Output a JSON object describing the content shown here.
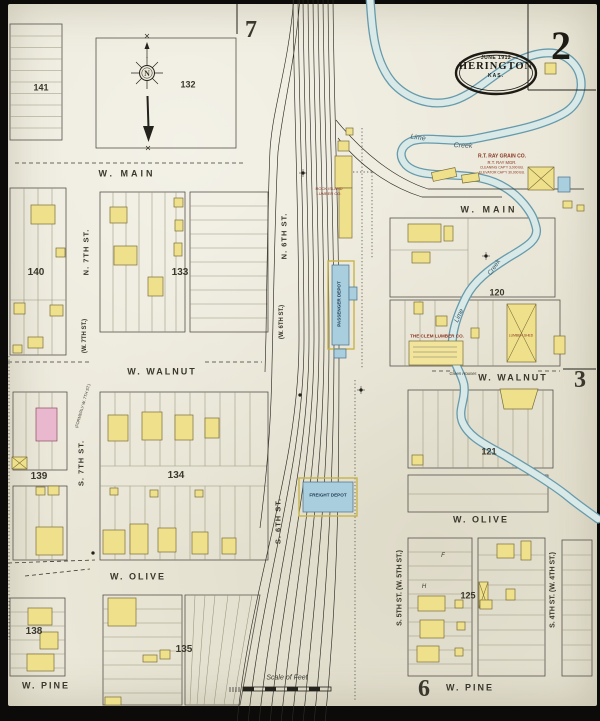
{
  "page": {
    "sheet_number": "2",
    "seal": {
      "date": "JUNE 1912",
      "city": "HERINGTON",
      "state": "KAS."
    },
    "adjacent_sheet_refs": {
      "top": "7",
      "right": "3",
      "bottom": "6"
    },
    "scale_label": "Scale of Feet",
    "compass_letter": "N"
  },
  "summary": {
    "streets_horizontal": [
      "W. MAIN",
      "W. WALNUT",
      "W. OLIVE",
      "W. PINE"
    ],
    "streets_vertical": [
      "N. 7TH ST.",
      "N. 6TH ST.",
      "S. 7TH ST.",
      "S. 6TH ST.",
      "S. 5TH ST.",
      "S. 4TH ST."
    ],
    "block_numbers": [
      "120",
      "121",
      "125",
      "132",
      "133",
      "134",
      "135",
      "138",
      "139",
      "140",
      "141"
    ],
    "landmarks": [
      "R.T. RAY GRAIN CO.",
      "THE CLEM LUMBER CO.",
      "ROCK ISLAND LUMBER CO.",
      "PASSENGER DEPOT",
      "FREIGHT DEPOT",
      "LIME CREEK"
    ]
  },
  "colors": {
    "paper": "#eae7d8",
    "border_black": "#0c0b09",
    "ink": "#3a382c",
    "red": "#8a3420",
    "depot": "#1e3a52",
    "creekink": "#3a5560",
    "frame_yellow": "#efe08c",
    "brick_pink": "#e9b8ce",
    "stone_blue": "#a9cede",
    "creek_fill": "#d8e9e8",
    "creek_edge": "#679aab"
  },
  "labels": [
    {
      "n": "street-w-main-left",
      "t": "W.  MAIN",
      "x": 127,
      "y": 174,
      "s": 9,
      "ls": 3,
      "w": 1
    },
    {
      "n": "street-w-main-right",
      "t": "W.  MAIN",
      "x": 489,
      "y": 210,
      "s": 9,
      "ls": 3,
      "w": 1
    },
    {
      "n": "street-w-walnut-left",
      "t": "W.  WALNUT",
      "x": 162,
      "y": 372,
      "s": 9,
      "ls": 2,
      "w": 1
    },
    {
      "n": "street-w-walnut-right",
      "t": "W.  WALNUT",
      "x": 513,
      "y": 378,
      "s": 9,
      "ls": 2,
      "w": 1
    },
    {
      "n": "street-w-olive-left",
      "t": "W.  OLIVE",
      "x": 138,
      "y": 577,
      "s": 9,
      "ls": 2,
      "w": 1
    },
    {
      "n": "street-w-olive-right",
      "t": "W.  OLIVE",
      "x": 481,
      "y": 520,
      "s": 9,
      "ls": 2,
      "w": 1
    },
    {
      "n": "street-w-pine-left",
      "t": "W.  PINE",
      "x": 46,
      "y": 686,
      "s": 9,
      "ls": 2,
      "w": 1
    },
    {
      "n": "street-w-pine-right",
      "t": "W.  PINE",
      "x": 470,
      "y": 688,
      "s": 9,
      "ls": 2,
      "w": 1
    },
    {
      "n": "street-n-7th",
      "t": "N.  7TH  ST.",
      "x": 86,
      "y": 252,
      "s": 7.5,
      "r": -90,
      "ls": 1,
      "w": 1
    },
    {
      "n": "street-w-7th-former",
      "t": "(W.  7TH  ST.)",
      "x": 85,
      "y": 336,
      "s": 6,
      "r": -90,
      "w": 1
    },
    {
      "n": "street-n-6th",
      "t": "N.  6TH  ST.",
      "x": 284,
      "y": 236,
      "s": 7.5,
      "r": -90,
      "ls": 1,
      "w": 1
    },
    {
      "n": "street-w-6th-former",
      "t": "(W.  6TH  ST.)",
      "x": 282,
      "y": 322,
      "s": 6,
      "r": -90,
      "w": 1
    },
    {
      "n": "street-s-7th",
      "t": "S.  7TH  ST.",
      "x": 81,
      "y": 463,
      "s": 7.5,
      "r": -90,
      "ls": 1,
      "w": 1
    },
    {
      "n": "former-w-7th-note",
      "t": "(FORMERLY  W.  7TH  ST.)",
      "x": 83,
      "y": 406,
      "s": 4,
      "r": -74
    },
    {
      "n": "street-s-6th",
      "t": "S.  6TH  ST.",
      "x": 278,
      "y": 521,
      "s": 7.5,
      "r": -90,
      "ls": 1,
      "w": 1
    },
    {
      "n": "street-s-5th",
      "t": "S.  5TH  ST.  (W.  5TH  ST.)",
      "x": 400,
      "y": 588,
      "s": 7,
      "r": -90,
      "w": 1
    },
    {
      "n": "street-s-4th",
      "t": "S.  4TH  ST.  (W.  4TH  ST.)",
      "x": 553,
      "y": 590,
      "s": 7,
      "r": -90,
      "w": 1
    },
    {
      "n": "block-number-141",
      "t": "141",
      "x": 41,
      "y": 88,
      "s": 9,
      "w": 1
    },
    {
      "n": "block-number-132",
      "t": "132",
      "x": 188,
      "y": 85,
      "s": 9,
      "w": 1
    },
    {
      "n": "block-number-140",
      "t": "140",
      "x": 36,
      "y": 273,
      "s": 10,
      "w": 1
    },
    {
      "n": "block-number-133",
      "t": "133",
      "x": 180,
      "y": 273,
      "s": 10,
      "w": 1
    },
    {
      "n": "block-number-139",
      "t": "139",
      "x": 39,
      "y": 477,
      "s": 10,
      "w": 1
    },
    {
      "n": "block-number-134",
      "t": "134",
      "x": 176,
      "y": 476,
      "s": 10,
      "w": 1
    },
    {
      "n": "block-number-138",
      "t": "138",
      "x": 34,
      "y": 632,
      "s": 10,
      "w": 1
    },
    {
      "n": "block-number-135",
      "t": "135",
      "x": 184,
      "y": 650,
      "s": 10,
      "w": 1
    },
    {
      "n": "block-number-120",
      "t": "120",
      "x": 497,
      "y": 293,
      "s": 9,
      "w": 1
    },
    {
      "n": "block-number-121",
      "t": "121",
      "x": 489,
      "y": 452,
      "s": 9,
      "w": 1
    },
    {
      "n": "block-number-125",
      "t": "125",
      "x": 468,
      "y": 596,
      "s": 9,
      "w": 1
    },
    {
      "n": "adjacent-sheet-7",
      "t": "7",
      "x": 251,
      "y": 30,
      "s": 24,
      "f": "serif",
      "w": 1
    },
    {
      "n": "adjacent-sheet-3",
      "t": "3",
      "x": 580,
      "y": 380,
      "s": 24,
      "f": "serif",
      "w": 1
    },
    {
      "n": "adjacent-sheet-6",
      "t": "6",
      "x": 424,
      "y": 689,
      "s": 24,
      "f": "serif",
      "w": 1
    },
    {
      "n": "creek-name-lime-upper",
      "t": "Lime",
      "x": 418,
      "y": 138,
      "s": 7,
      "r": 8,
      "fs": 1,
      "c": "creekink"
    },
    {
      "n": "creek-name-creek-upper",
      "t": "Creek",
      "x": 463,
      "y": 146,
      "s": 7,
      "r": 2,
      "fs": 1,
      "c": "creekink"
    },
    {
      "n": "creek-name-lime-lower",
      "t": "Lime",
      "x": 460,
      "y": 316,
      "s": 6.5,
      "r": -65,
      "fs": 1,
      "c": "creekink"
    },
    {
      "n": "creek-name-creek-lower",
      "t": "Creek",
      "x": 495,
      "y": 268,
      "s": 6.5,
      "r": -55,
      "fs": 1,
      "c": "creekink"
    },
    {
      "n": "ray-grain-co-name",
      "t": "R.T. RAY GRAIN CO.",
      "x": 502,
      "y": 157,
      "s": 5,
      "c": "red",
      "w": 1
    },
    {
      "n": "ray-grain-co-mgr",
      "t": "R.T. RAY MGR.",
      "x": 502,
      "y": 163,
      "s": 4.2,
      "c": "red"
    },
    {
      "n": "ray-grain-co-note-1",
      "t": "CLEANING CAP'Y 3,000 BU.",
      "x": 502,
      "y": 168,
      "s": 3.4,
      "c": "red"
    },
    {
      "n": "ray-grain-co-note-2",
      "t": "ELEVATOR CAP'Y 30,000 BU.",
      "x": 502,
      "y": 172.5,
      "s": 3.4,
      "c": "red"
    },
    {
      "n": "clem-lumber-co-name",
      "t": "THE CLEM LUMBER CO.",
      "x": 437,
      "y": 337,
      "s": 4.6,
      "c": "red",
      "w": 1
    },
    {
      "n": "rock-island-lumber-1",
      "t": "ROCK ISLAND",
      "x": 329,
      "y": 189,
      "s": 4,
      "c": "red"
    },
    {
      "n": "rock-island-lumber-2",
      "t": "LUMBER CO.",
      "x": 329,
      "y": 194,
      "s": 4,
      "c": "red"
    },
    {
      "n": "lumber-shed-label",
      "t": "LUMBER SHED",
      "x": 521,
      "y": 336,
      "s": 3.4,
      "c": "red"
    },
    {
      "n": "passenger-depot-label",
      "t": "PASSENGER  DEPOT",
      "x": 340,
      "y": 304,
      "s": 4.6,
      "r": -90,
      "c": "depot",
      "w": 1
    },
    {
      "n": "freight-depot-label",
      "t": "FREIGHT  DEPOT",
      "x": 328,
      "y": 496,
      "s": 4.6,
      "c": "depot",
      "w": 1
    },
    {
      "n": "green-houses-label",
      "t": "Green Houses",
      "x": 463,
      "y": 374,
      "s": 4.2,
      "fs": 1
    },
    {
      "n": "scale-of-feet-label",
      "t": "Scale of Feet",
      "x": 287,
      "y": 678,
      "s": 7,
      "fs": 1
    },
    {
      "n": "compass-north-letter",
      "t": "N",
      "x": 147,
      "y": 74,
      "s": 8,
      "f": "serif",
      "w": 1
    },
    {
      "n": "lot-letter-f",
      "t": "F",
      "x": 443,
      "y": 556,
      "s": 6,
      "fs": 1
    },
    {
      "n": "lot-letter-h",
      "t": "H",
      "x": 424,
      "y": 587,
      "s": 6,
      "fs": 1
    }
  ]
}
